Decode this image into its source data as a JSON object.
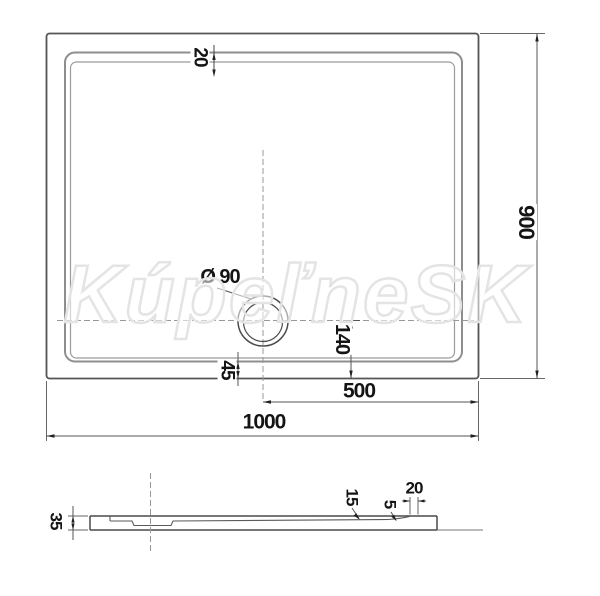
{
  "drawing": {
    "watermark": "KúpeľneSK",
    "top_view": {
      "rim_width_label": "20",
      "height_label": "900",
      "drain_diameter_label": "Ø 90",
      "drain_offset_label": "140",
      "rim_to_edge_label": "45",
      "drain_to_edge_label": "500",
      "width_label": "1000"
    },
    "section_view": {
      "total_height_label": "35",
      "floor_depth_label": "15",
      "slope_label": "5",
      "edge_width_label": "20"
    }
  }
}
